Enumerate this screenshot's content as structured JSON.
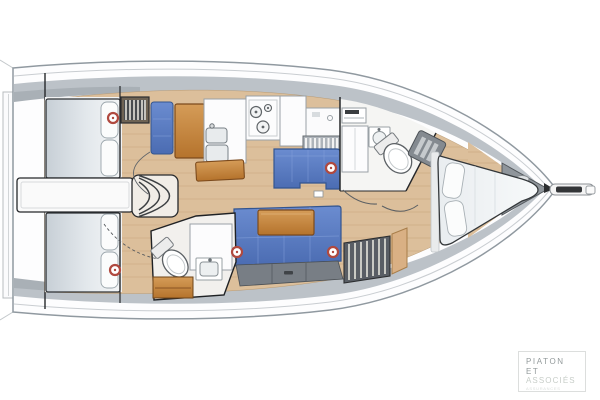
{
  "plan": {
    "type": "yacht-interior-floorplan",
    "vessel": "sailing-yacht-deck-plan",
    "orientation": "bow-right-stern-left",
    "rooms": [
      {
        "name": "swim-platform"
      },
      {
        "name": "aft-cabin-starboard"
      },
      {
        "name": "aft-cabin-port"
      },
      {
        "name": "companionway-steps"
      },
      {
        "name": "engine-box"
      },
      {
        "name": "nav-station"
      },
      {
        "name": "galley"
      },
      {
        "name": "aft-head"
      },
      {
        "name": "saloon"
      },
      {
        "name": "forward-head"
      },
      {
        "name": "forward-cabin"
      },
      {
        "name": "anchor-locker"
      },
      {
        "name": "bowsprit"
      }
    ],
    "fixtures": {
      "stove_burners": 3,
      "sinks": 4,
      "toilets": 2,
      "berths": 3,
      "porthole_rings": 5,
      "hanging_lockers": 2
    }
  },
  "palette": {
    "hull_stroke": "#9099a0",
    "sheer_line": "#c9cdd1",
    "deck_gray": "#bcc2c8",
    "coaming_gray": "#a9b0b6",
    "floor_wood": "#dcbf9b",
    "floor_wood_line": "#c39e74",
    "furniture_wood": "#c8813d",
    "furniture_wood_dark": "#7c4a1c",
    "upholstery_blue": "#5b7dc0",
    "upholstery_blue_dark": "#33558f",
    "mattress_light": "#f1f3f4",
    "mattress_shade": "#c9d1d7",
    "fixture_white": "#fcfcfd",
    "fixture_stroke": "#9aa1a6",
    "wall_line": "#26282b",
    "grate_gray": "#848a90",
    "locker_dark": "#595e65",
    "tan_seat": "#d9b084",
    "ring_red": "#b0493f"
  },
  "logo": {
    "line1": "PIATON",
    "line2": "ET",
    "line3": "ASSOCIÉS",
    "tagline": "ASSURANCES"
  }
}
